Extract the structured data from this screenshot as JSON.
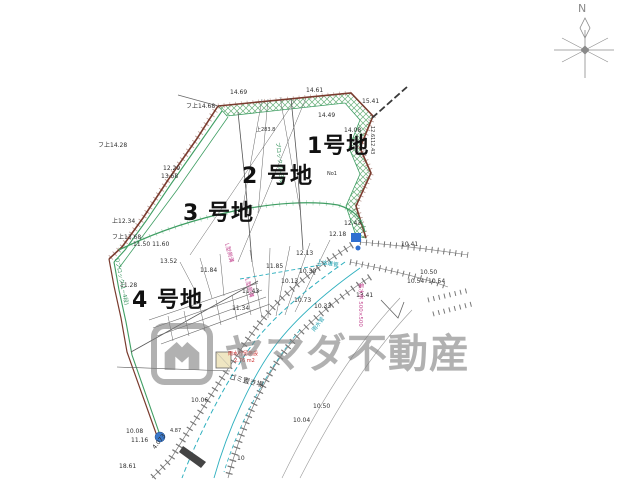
{
  "palette": {
    "k": "#2e2e2e",
    "lk": "#111111",
    "p": "#c2458f",
    "g": "#2f8f57",
    "t": "#1fa0b0",
    "r": "#cc2f2f",
    "b": "#2b5fd9",
    "boundary": "#7a3b2e",
    "green_line": "#3f9e63",
    "cyan_line": "#2fb0bf",
    "road": "#777777",
    "watermark_gray": "#7d7d7d"
  },
  "compass": {
    "n": "N"
  },
  "watermark": {
    "text": "ヤマダ不動産"
  },
  "lots": [
    {
      "t": "1号地",
      "x": 307,
      "y": 136,
      "s": 22,
      "w": "bold",
      "c": "lk"
    },
    {
      "t": "2 号地",
      "x": 242,
      "y": 166,
      "s": 22,
      "w": "bold",
      "c": "lk"
    },
    {
      "t": "3 号地",
      "x": 183,
      "y": 203,
      "s": 22,
      "w": "bold",
      "c": "lk"
    },
    {
      "t": "4 号地",
      "x": 132,
      "y": 290,
      "s": 22,
      "w": "bold",
      "c": "lk"
    }
  ],
  "annotations": [
    {
      "t": "14.69",
      "x": 230,
      "y": 90
    },
    {
      "t": "14.61",
      "x": 306,
      "y": 88
    },
    {
      "t": "15.41",
      "x": 362,
      "y": 99
    },
    {
      "t": "14.49",
      "x": 318,
      "y": 113
    },
    {
      "t": "14.08",
      "x": 344,
      "y": 128
    },
    {
      "t": "フ上14.68",
      "x": 186,
      "y": 104
    },
    {
      "t": "フ上14.28",
      "x": 98,
      "y": 143
    },
    {
      "t": "上283.8",
      "x": 256,
      "y": 128,
      "s": 5
    },
    {
      "t": "12.29",
      "x": 163,
      "y": 166
    },
    {
      "t": "13.68",
      "x": 161,
      "y": 174
    },
    {
      "t": "上12.34",
      "x": 112,
      "y": 219
    },
    {
      "t": "フ上13.68",
      "x": 112,
      "y": 235
    },
    {
      "t": "11.50 11.60",
      "x": 133,
      "y": 242
    },
    {
      "t": "13.52",
      "x": 160,
      "y": 259
    },
    {
      "t": "11.28",
      "x": 120,
      "y": 283
    },
    {
      "t": "11.84",
      "x": 200,
      "y": 268
    },
    {
      "t": "11.85",
      "x": 266,
      "y": 264
    },
    {
      "t": "12.13",
      "x": 296,
      "y": 251
    },
    {
      "t": "11.43",
      "x": 242,
      "y": 289
    },
    {
      "t": "10.30",
      "x": 299,
      "y": 269
    },
    {
      "t": "10.13",
      "x": 281,
      "y": 279
    },
    {
      "t": "11.34",
      "x": 232,
      "y": 306
    },
    {
      "t": "10.73",
      "x": 294,
      "y": 298
    },
    {
      "t": "10.33",
      "x": 314,
      "y": 304
    },
    {
      "t": "12.43",
      "x": 344,
      "y": 221
    },
    {
      "t": "12.18",
      "x": 329,
      "y": 232
    },
    {
      "t": "10.41",
      "x": 401,
      "y": 242
    },
    {
      "t": "10.50",
      "x": 420,
      "y": 270
    },
    {
      "t": "10.54",
      "x": 407,
      "y": 279
    },
    {
      "t": "10.54",
      "x": 428,
      "y": 279
    },
    {
      "t": "13.41",
      "x": 356,
      "y": 293
    },
    {
      "t": "10.06",
      "x": 191,
      "y": 398
    },
    {
      "t": "10.50",
      "x": 313,
      "y": 404
    },
    {
      "t": "10.04",
      "x": 293,
      "y": 418
    },
    {
      "t": "10",
      "x": 237,
      "y": 456
    },
    {
      "t": "10.08",
      "x": 126,
      "y": 429
    },
    {
      "t": "11.16",
      "x": 131,
      "y": 438
    },
    {
      "t": "18.61",
      "x": 119,
      "y": 464
    },
    {
      "t": "4.87",
      "x": 170,
      "y": 429,
      "s": 5
    },
    {
      "t": "4.073",
      "x": 152,
      "y": 447,
      "r": -52,
      "s": 6
    },
    {
      "t": "No1",
      "x": 327,
      "y": 172,
      "s": 5
    },
    {
      "t": "12.61",
      "x": 374,
      "y": 126,
      "r": 90,
      "s": 5
    },
    {
      "t": "12.43",
      "x": 374,
      "y": 140,
      "r": 90,
      "s": 5
    },
    {
      "t": "雨水貯留施設",
      "x": 228,
      "y": 352,
      "c": "r",
      "s": 5
    },
    {
      "t": "2.76 m2",
      "x": 234,
      "y": 359,
      "c": "r",
      "s": 5
    },
    {
      "t": "ゴミ置き場",
      "x": 230,
      "y": 374,
      "s": 7,
      "r": 14
    },
    {
      "t": "集水桝 500×500",
      "x": 362,
      "y": 283,
      "c": "p",
      "r": 90,
      "s": 5.5
    },
    {
      "t": "L型側溝",
      "x": 228,
      "y": 243,
      "c": "p",
      "r": 75,
      "s": 5.5
    },
    {
      "t": "L型側溝",
      "x": 248,
      "y": 278,
      "c": "p",
      "r": 75,
      "s": 5.5
    },
    {
      "t": "Dブロック(1~4段)",
      "x": 118,
      "y": 258,
      "c": "g",
      "r": 78,
      "s": 5.5
    },
    {
      "t": "ブロック(1~3段)",
      "x": 279,
      "y": 142,
      "c": "g",
      "r": 84,
      "s": 5.5
    },
    {
      "t": "上水道管",
      "x": 317,
      "y": 260,
      "c": "t",
      "r": 10,
      "s": 5.5
    },
    {
      "t": "雨水管",
      "x": 312,
      "y": 330,
      "c": "t",
      "r": -52,
      "s": 5.5
    }
  ]
}
